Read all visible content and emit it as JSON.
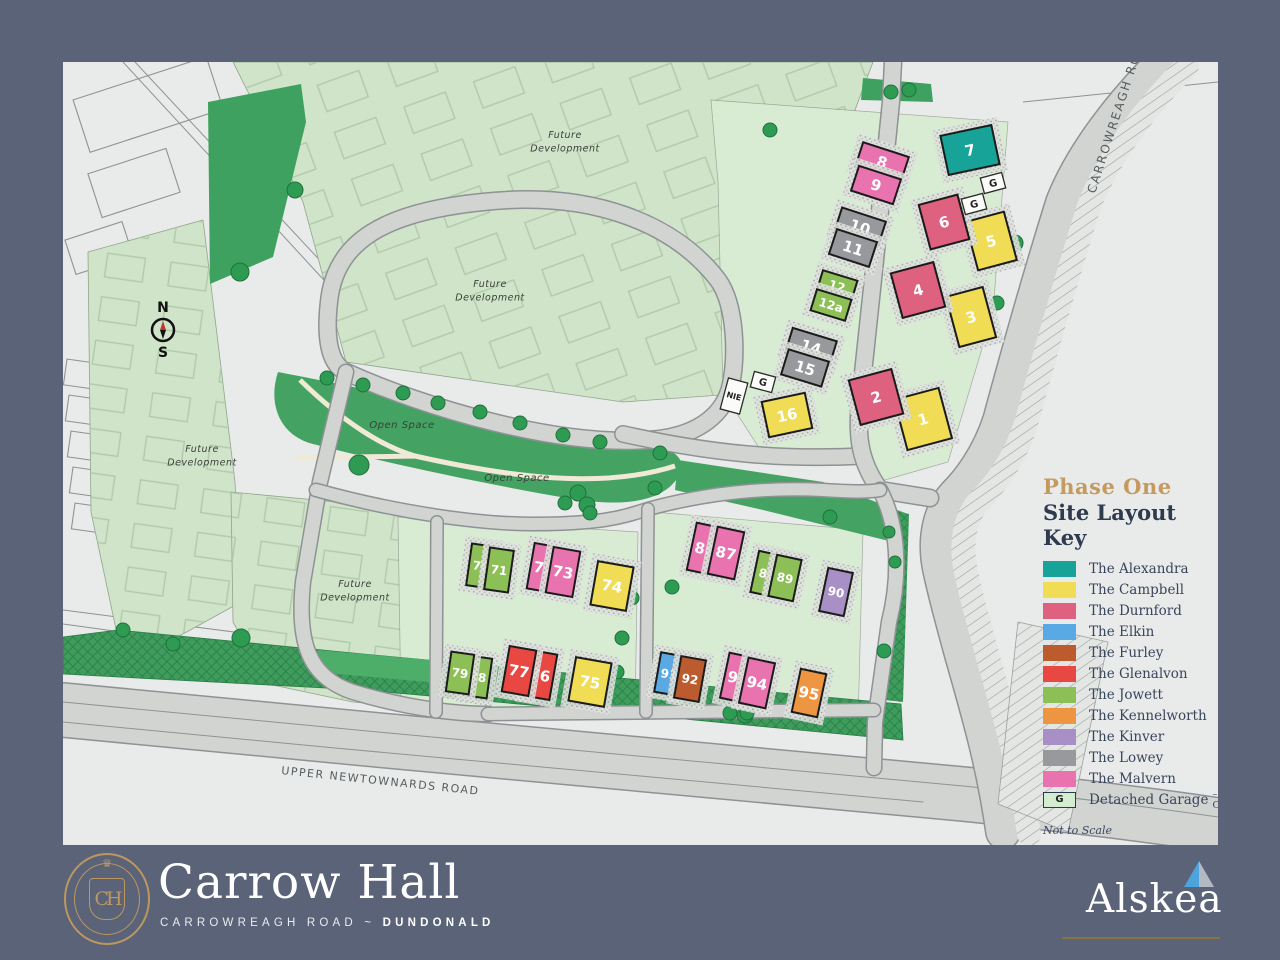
{
  "house_types": {
    "alexandra": {
      "label": "The Alexandra",
      "color": "#17A398"
    },
    "campbell": {
      "label": "The Campbell",
      "color": "#F0DC55"
    },
    "durnford": {
      "label": "The Durnford",
      "color": "#DE6180"
    },
    "elkin": {
      "label": "The Elkin",
      "color": "#58A9E4"
    },
    "furley": {
      "label": "The Furley",
      "color": "#BC5B2E"
    },
    "glenalvon": {
      "label": "The Glenalvon",
      "color": "#E94742"
    },
    "jowett": {
      "label": "The Jowett",
      "color": "#8CBF55"
    },
    "kennelworth": {
      "label": "The Kennelworth",
      "color": "#EE9542"
    },
    "kinver": {
      "label": "The Kinver",
      "color": "#A88FC6"
    },
    "lowey": {
      "label": "The Lowey",
      "color": "#97999C"
    },
    "malvern": {
      "label": "The Malvern",
      "color": "#E873AE"
    }
  },
  "legend": {
    "phase": "Phase One",
    "title": "Site Layout Key",
    "order": [
      "alexandra",
      "campbell",
      "durnford",
      "elkin",
      "furley",
      "glenalvon",
      "jowett",
      "kennelworth",
      "kinver",
      "lowey",
      "malvern"
    ],
    "garage_item": {
      "symbol": "G",
      "label": "Detached Garage",
      "suffix": "– Optional",
      "color": "#D4EDD1"
    },
    "note": "Not to Scale"
  },
  "map": {
    "labels": [
      {
        "id": "future-dev-1",
        "lines": [
          "Future",
          "Development"
        ],
        "x": 502,
        "y": 76,
        "size": 9.5
      },
      {
        "id": "future-dev-2",
        "lines": [
          "Future",
          "Development"
        ],
        "x": 427,
        "y": 225,
        "size": 9.5
      },
      {
        "id": "future-dev-3",
        "lines": [
          "Future",
          "Development"
        ],
        "x": 139,
        "y": 390,
        "size": 9.5
      },
      {
        "id": "future-dev-4",
        "lines": [
          "Future",
          "Development"
        ],
        "x": 292,
        "y": 525,
        "size": 9.5
      },
      {
        "id": "open-space-1",
        "lines": [
          "Open Space"
        ],
        "x": 339,
        "y": 366,
        "size": 10
      },
      {
        "id": "open-space-2",
        "lines": [
          "Open Space"
        ],
        "x": 454,
        "y": 419,
        "size": 10
      }
    ],
    "road_labels": [
      {
        "id": "carrowreagh-road",
        "text": "CARROWREAGH ROAD",
        "x": 1032,
        "y": 132,
        "rotate": -72,
        "size": 12,
        "spacing": 2
      },
      {
        "id": "upper-newtownards-road",
        "text": "UPPER NEWTOWNARDS ROAD",
        "x": 218,
        "y": 712,
        "rotate": 6,
        "size": 11,
        "spacing": 1.5
      }
    ],
    "compass": {
      "north": "N",
      "south": "S",
      "x": 100,
      "y": 268
    },
    "utility": {
      "label": "NIE",
      "x": 671,
      "y": 334,
      "rot": 15
    },
    "garages": [
      {
        "label": "G",
        "x": 930,
        "y": 121,
        "rot": -15
      },
      {
        "label": "G",
        "x": 911,
        "y": 142,
        "rot": -15
      },
      {
        "label": "G",
        "x": 700,
        "y": 320,
        "rot": 15
      }
    ],
    "plots": [
      {
        "number": "1",
        "type": "campbell",
        "x": 860,
        "y": 357,
        "w": 46,
        "h": 52,
        "rot": -15
      },
      {
        "number": "2",
        "type": "durnford",
        "x": 813,
        "y": 335,
        "w": 44,
        "h": 46,
        "rot": -15
      },
      {
        "number": "3",
        "type": "campbell",
        "x": 908,
        "y": 255,
        "w": 38,
        "h": 52,
        "rot": -15
      },
      {
        "number": "4",
        "type": "durnford",
        "x": 855,
        "y": 228,
        "w": 44,
        "h": 46,
        "rot": -15
      },
      {
        "number": "5",
        "type": "campbell",
        "x": 928,
        "y": 179,
        "w": 40,
        "h": 50,
        "rot": -15
      },
      {
        "number": "6",
        "type": "durnford",
        "x": 881,
        "y": 160,
        "w": 40,
        "h": 46,
        "rot": -15
      },
      {
        "number": "7",
        "type": "alexandra",
        "x": 907,
        "y": 88,
        "w": 52,
        "h": 40,
        "rot": -12
      },
      {
        "number": "8",
        "type": "malvern",
        "x": 819,
        "y": 100,
        "w": 48,
        "h": 26,
        "rot": 18
      },
      {
        "number": "9",
        "type": "malvern",
        "x": 813,
        "y": 123,
        "w": 44,
        "h": 26,
        "rot": 18
      },
      {
        "number": "10",
        "type": "lowey",
        "x": 797,
        "y": 165,
        "w": 46,
        "h": 26,
        "rot": 18
      },
      {
        "number": "11",
        "type": "lowey",
        "x": 790,
        "y": 186,
        "w": 42,
        "h": 26,
        "rot": 18
      },
      {
        "number": "12",
        "type": "jowett",
        "x": 774,
        "y": 224,
        "w": 36,
        "h": 22,
        "rot": 17
      },
      {
        "number": "12a",
        "type": "jowett",
        "x": 768,
        "y": 243,
        "w": 36,
        "h": 22,
        "rot": 17
      },
      {
        "number": "14",
        "type": "lowey",
        "x": 748,
        "y": 285,
        "w": 46,
        "h": 26,
        "rot": 17
      },
      {
        "number": "15",
        "type": "lowey",
        "x": 742,
        "y": 306,
        "w": 42,
        "h": 26,
        "rot": 17
      },
      {
        "number": "16",
        "type": "campbell",
        "x": 724,
        "y": 353,
        "w": 44,
        "h": 36,
        "rot": -12
      },
      {
        "number": "70",
        "type": "jowett",
        "x": 418,
        "y": 504,
        "w": 24,
        "h": 42,
        "rot": 8
      },
      {
        "number": "71",
        "type": "jowett",
        "x": 436,
        "y": 508,
        "w": 24,
        "h": 42,
        "rot": 8
      },
      {
        "number": "72",
        "type": "malvern",
        "x": 481,
        "y": 506,
        "w": 27,
        "h": 46,
        "rot": 10
      },
      {
        "number": "73",
        "type": "malvern",
        "x": 500,
        "y": 510,
        "w": 27,
        "h": 46,
        "rot": 10
      },
      {
        "number": "74",
        "type": "campbell",
        "x": 549,
        "y": 524,
        "w": 36,
        "h": 44,
        "rot": 10
      },
      {
        "number": "75",
        "type": "campbell",
        "x": 527,
        "y": 620,
        "w": 36,
        "h": 44,
        "rot": 10
      },
      {
        "number": "76",
        "type": "glenalvon",
        "x": 477,
        "y": 613,
        "w": 27,
        "h": 46,
        "rot": 10
      },
      {
        "number": "77",
        "type": "glenalvon",
        "x": 456,
        "y": 609,
        "w": 27,
        "h": 46,
        "rot": 10
      },
      {
        "number": "78",
        "type": "jowett",
        "x": 415,
        "y": 615,
        "w": 23,
        "h": 40,
        "rot": 8
      },
      {
        "number": "79",
        "type": "jowett",
        "x": 397,
        "y": 611,
        "w": 23,
        "h": 40,
        "rot": 8
      },
      {
        "number": "86",
        "type": "malvern",
        "x": 642,
        "y": 487,
        "w": 27,
        "h": 48,
        "rot": 12
      },
      {
        "number": "87",
        "type": "malvern",
        "x": 663,
        "y": 491,
        "w": 27,
        "h": 48,
        "rot": 12
      },
      {
        "number": "88",
        "type": "jowett",
        "x": 704,
        "y": 512,
        "w": 25,
        "h": 42,
        "rot": 12
      },
      {
        "number": "89",
        "type": "jowett",
        "x": 722,
        "y": 516,
        "w": 25,
        "h": 42,
        "rot": 12
      },
      {
        "number": "90",
        "type": "kinver",
        "x": 773,
        "y": 530,
        "w": 25,
        "h": 44,
        "rot": 12
      },
      {
        "number": "91",
        "type": "elkin",
        "x": 606,
        "y": 612,
        "w": 23,
        "h": 40,
        "rot": 10
      },
      {
        "number": "92",
        "type": "furley",
        "x": 627,
        "y": 617,
        "w": 25,
        "h": 42,
        "rot": 10
      },
      {
        "number": "93",
        "type": "malvern",
        "x": 675,
        "y": 616,
        "w": 27,
        "h": 46,
        "rot": 12
      },
      {
        "number": "94",
        "type": "malvern",
        "x": 694,
        "y": 621,
        "w": 27,
        "h": 46,
        "rot": 12
      },
      {
        "number": "95",
        "type": "kennelworth",
        "x": 746,
        "y": 631,
        "w": 26,
        "h": 44,
        "rot": 12
      }
    ],
    "trees": [
      [
        177,
        210,
        9
      ],
      [
        232,
        128,
        8
      ],
      [
        707,
        68,
        7
      ],
      [
        828,
        30,
        7
      ],
      [
        846,
        28,
        7
      ],
      [
        952,
        181,
        8
      ],
      [
        934,
        241,
        7
      ],
      [
        264,
        316,
        7
      ],
      [
        300,
        323,
        7
      ],
      [
        340,
        331,
        7
      ],
      [
        375,
        341,
        7
      ],
      [
        417,
        350,
        7
      ],
      [
        457,
        361,
        7
      ],
      [
        500,
        373,
        7
      ],
      [
        537,
        380,
        7
      ],
      [
        296,
        403,
        10
      ],
      [
        515,
        431,
        8
      ],
      [
        524,
        443,
        8
      ],
      [
        502,
        441,
        7
      ],
      [
        527,
        451,
        7
      ],
      [
        597,
        391,
        7
      ],
      [
        592,
        426,
        7
      ],
      [
        682,
        653,
        8
      ],
      [
        821,
        589,
        7
      ],
      [
        767,
        455,
        7
      ],
      [
        609,
        525,
        7
      ],
      [
        667,
        651,
        7
      ],
      [
        684,
        651,
        7
      ],
      [
        569,
        536,
        7
      ],
      [
        559,
        576,
        7
      ],
      [
        554,
        610,
        7
      ],
      [
        178,
        576,
        9
      ],
      [
        110,
        582,
        7
      ],
      [
        60,
        568,
        7
      ],
      [
        826,
        470,
        6
      ],
      [
        832,
        500,
        6
      ]
    ]
  },
  "footer": {
    "brand": {
      "monogram": "CH",
      "name": "Carrow Hall",
      "tagline_left": "CARROWREAGH ROAD",
      "tagline_sep": "~",
      "tagline_right": "DUNDONALD"
    },
    "developer": {
      "name": "Alskea"
    }
  }
}
